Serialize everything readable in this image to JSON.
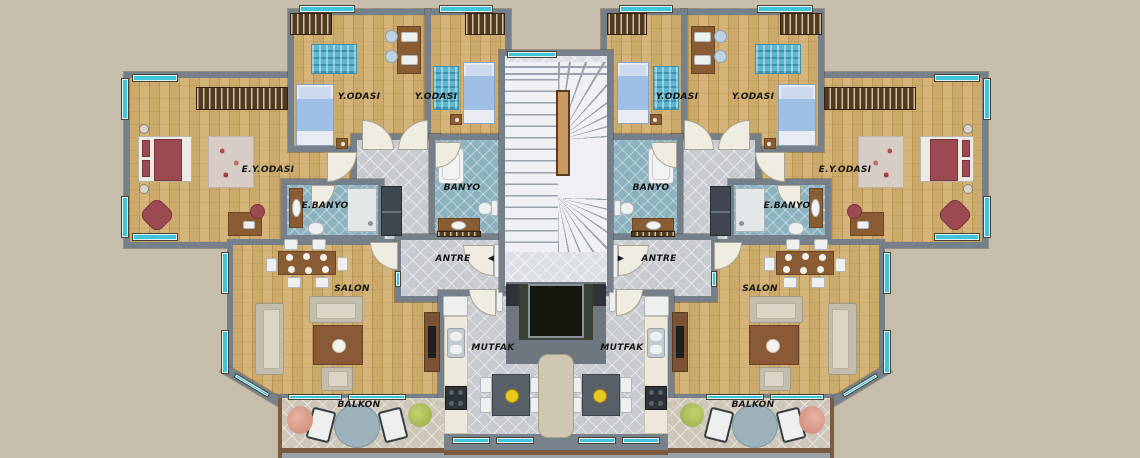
{
  "type": "architectural_floor_plan",
  "units": {
    "left": {
      "rooms": [
        "E.Y.ODASI",
        "Y.ODASI",
        "Y.ODASI",
        "E.BANYO",
        "BANYO",
        "ANTRE",
        "MUTFAK",
        "SALON",
        "BALKON"
      ]
    },
    "right": {
      "rooms": [
        "E.Y.ODASI",
        "Y.ODASI",
        "Y.ODASI",
        "E.BANYO",
        "BANYO",
        "ANTRE",
        "MUTFAK",
        "SALON",
        "BALKON"
      ]
    }
  },
  "labels": {
    "ey_odasi_l": {
      "text": "E.Y.ODASI"
    },
    "ey_odasi_r": {
      "text": "E.Y.ODASI"
    },
    "y_odasi_l1": {
      "text": "Y.ODASI"
    },
    "y_odasi_l2": {
      "text": "Y.ODASI"
    },
    "y_odasi_r1": {
      "text": "Y.ODASI"
    },
    "y_odasi_r2": {
      "text": "Y.ODASI"
    },
    "e_banyo_l": {
      "text": "E.BANYO"
    },
    "e_banyo_r": {
      "text": "E.BANYO"
    },
    "banyo_l": {
      "text": "BANYO"
    },
    "banyo_r": {
      "text": "BANYO"
    },
    "antre_l": {
      "text": "ANTRE"
    },
    "antre_r": {
      "text": "ANTRE"
    },
    "entry_arrow_l": {
      "text": "◀"
    },
    "entry_arrow_r": {
      "text": "▶"
    },
    "mutfak_l": {
      "text": "MUTFAK"
    },
    "mutfak_r": {
      "text": "MUTFAK"
    },
    "salon_l": {
      "text": "SALON"
    },
    "salon_r": {
      "text": "SALON"
    },
    "balkon_l": {
      "text": "BALKON"
    },
    "balkon_r": {
      "text": "BALKON"
    }
  },
  "palette": {
    "background": "#c6bdad",
    "wall": "#75808b",
    "wood_floor": "#c9a768",
    "tile_floor": "#c8ccd0",
    "bath_floor": "#8cb2bf",
    "balcony_floor": "#cdc7b9",
    "window_glass": "#3fc4da",
    "stair_fill": "#eef0f3",
    "elevator_cab": "#15170f",
    "master_bed": "#9c4a52",
    "single_bed": "#9fc0e4",
    "furniture_wood": "#8a5c34",
    "kitchen_plate": "#e8c81f"
  }
}
